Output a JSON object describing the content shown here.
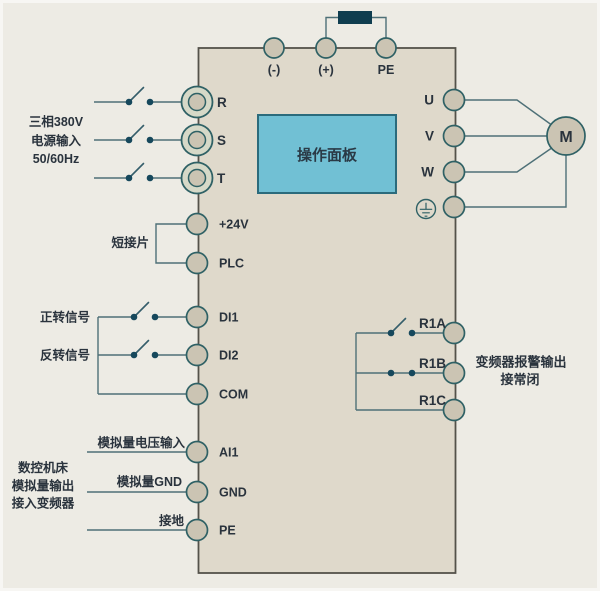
{
  "colors": {
    "background": "#EDEBE4",
    "box_fill": "#DFD9CB",
    "box_border": "#54524A",
    "panel_fill": "#71C0D4",
    "panel_border": "#2B6B7C",
    "wire": "#4E7077",
    "terminal_fill": "#CBC4B3",
    "terminal_ring_fill": "#D6D9C8",
    "terminal_border": "#2F6165",
    "switch_dot": "#16485C",
    "resistor_fill": "#0F3D4F",
    "text": "#2A333D"
  },
  "panel": {
    "label": "操作面板"
  },
  "motor": {
    "label": "M"
  },
  "power_input": {
    "lines": [
      "三相380V",
      "电源输入",
      "50/60Hz"
    ]
  },
  "cnc": {
    "lines": [
      "数控机床",
      "模拟量输出",
      "接入变频器"
    ]
  },
  "labels": {
    "jumper": "短接片",
    "forward": "正转信号",
    "reverse": "反转信号",
    "analog_voltage": "模拟量电压输入",
    "analog_gnd": "模拟量GND",
    "earth": "接地",
    "relay_note_1": "变频器报警输出",
    "relay_note_2": "接常闭"
  },
  "terminals": {
    "top": [
      "(-)",
      "(+)",
      "PE"
    ],
    "power": [
      "R",
      "S",
      "T"
    ],
    "control": [
      "+24V",
      "PLC",
      "DI1",
      "DI2",
      "COM",
      "AI1",
      "GND",
      "PE"
    ],
    "output": [
      "U",
      "V",
      "W"
    ],
    "relay": [
      "R1A",
      "R1B",
      "R1C"
    ]
  }
}
